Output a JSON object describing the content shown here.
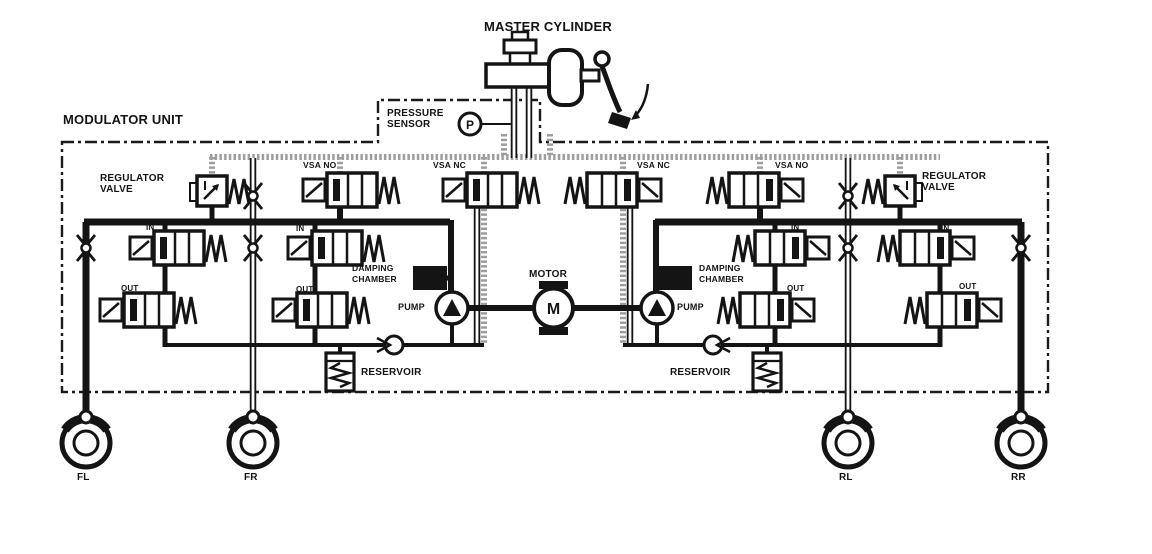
{
  "diagram": {
    "master_cylinder_label": "MASTER CYLINDER",
    "modulator_unit_label": "MODULATOR UNIT",
    "pressure_sensor": {
      "line1": "PRESSURE",
      "line2": "SENSOR",
      "symbol": "P"
    },
    "motor": {
      "label": "MOTOR",
      "symbol": "M"
    }
  },
  "left_bank": {
    "regulator_line1": "REGULATOR",
    "regulator_line2": "VALVE",
    "vsa_no": "VSA NO",
    "vsa_nc": "VSA NC",
    "in1": "IN",
    "in2": "IN",
    "out1": "OUT",
    "out2": "OUT",
    "damping_line1": "DAMPING",
    "damping_line2": "CHAMBER",
    "pump": "PUMP",
    "reservoir": "RESERVOIR"
  },
  "right_bank": {
    "regulator_line1": "REGULATOR",
    "regulator_line2": "VALVE",
    "vsa_no": "VSA NO",
    "vsa_nc": "VSA NC",
    "in1": "IN",
    "in2": "IN",
    "out1": "OUT",
    "out2": "OUT",
    "damping_line1": "DAMPING",
    "damping_line2": "CHAMBER",
    "pump": "PUMP",
    "reservoir": "RESERVOIR"
  },
  "wheels": {
    "front_left": "FL",
    "front_right": "FR",
    "rear_left": "RL",
    "rear_right": "RR"
  },
  "colors": {
    "ink": "#141414",
    "gray_pipe": "#9e9e9e",
    "background": "#ffffff"
  }
}
